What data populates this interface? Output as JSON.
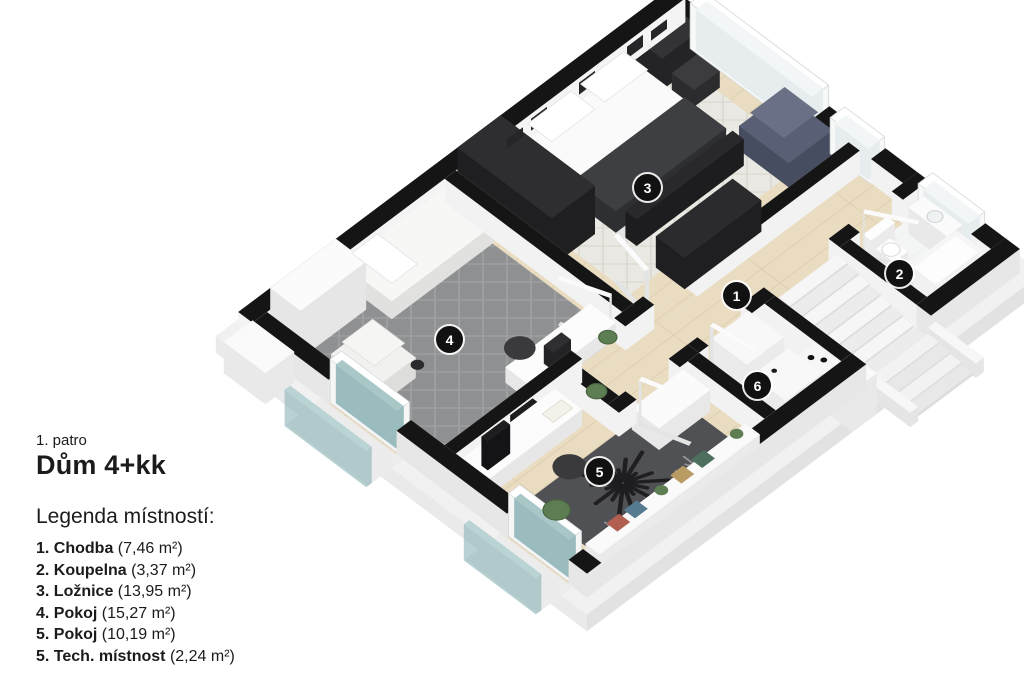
{
  "header": {
    "floor_label": "1. patro",
    "title": "Dům 4+kk"
  },
  "legend": {
    "heading": "Legenda místností:",
    "items": [
      {
        "number": "1.",
        "name": "Chodba",
        "area": "(7,46 m²)"
      },
      {
        "number": "2.",
        "name": "Koupelna",
        "area": "(3,37 m²)"
      },
      {
        "number": "3.",
        "name": "Ložnice",
        "area": "(13,95 m²)"
      },
      {
        "number": "4.",
        "name": "Pokoj",
        "area": "(15,27 m²)"
      },
      {
        "number": "5.",
        "name": "Pokoj",
        "area": "(10,19 m²)"
      },
      {
        "number": "5.",
        "name": "Tech. místnost",
        "area": "(2,24 m²)"
      }
    ]
  },
  "badges": [
    {
      "number": "1"
    },
    {
      "number": "2"
    },
    {
      "number": "3"
    },
    {
      "number": "4"
    },
    {
      "number": "5"
    },
    {
      "number": "6"
    }
  ],
  "colors": {
    "wall": "#151515",
    "wall_side": "#f2f2f2",
    "wall_side_outer": "#e7e7e7",
    "wood": "#e9dcc1",
    "wood_line": "#d9c8a6",
    "rug_room4": "#8e9091",
    "rug_room4_line": "#a0a2a3",
    "rug_room3": "#eae8e2",
    "rug_room3_line": "#dbd8d0",
    "rug_room5": "#505155",
    "glass": "#8bb2b4",
    "armchair_blue": "#596075",
    "dark_furniture": "#2b2b2d",
    "plant": "#5d7d52"
  }
}
